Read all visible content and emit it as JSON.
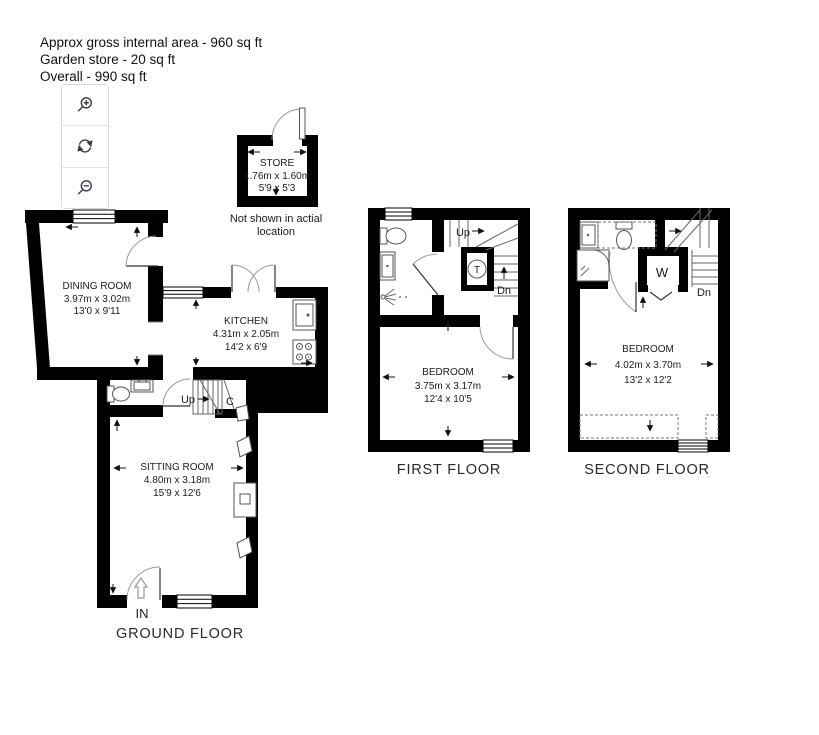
{
  "header": {
    "lines": [
      "Approx gross internal area - 960 sq ft",
      "Garden store - 20 sq ft",
      "Overall - 990 sq ft"
    ]
  },
  "toolbar": {
    "icons": [
      "magnifier-plus",
      "rotate-arrows",
      "magnifier-minus"
    ]
  },
  "store": {
    "name": "STORE",
    "size_metric": "1.76m x 1.60m",
    "size_imperial": "5'9 x 5'3",
    "note_line1": "Not shown in actial",
    "note_line2": "location"
  },
  "floors": {
    "ground": {
      "label": "GROUND FLOOR",
      "rooms": {
        "dining": {
          "name": "DINING ROOM",
          "metric": "3.97m x 3.02m",
          "imperial": "13'0 x 9'11"
        },
        "kitchen": {
          "name": "KITCHEN",
          "metric": "4.31m x 2.05m",
          "imperial": "14'2 x 6'9"
        },
        "sitting": {
          "name": "SITTING ROOM",
          "metric": "4.80m x 3.18m",
          "imperial": "15'9 x 12'6"
        }
      },
      "annotations": {
        "up": "Up",
        "cupboard": "C",
        "entrance": "IN"
      }
    },
    "first": {
      "label": "FIRST FLOOR",
      "rooms": {
        "bedroom": {
          "name": "BEDROOM",
          "metric": "3.75m x 3.17m",
          "imperial": "12'4 x 10'5"
        }
      },
      "annotations": {
        "up": "Up",
        "down": "Dn",
        "tank": "T"
      }
    },
    "second": {
      "label": "SECOND FLOOR",
      "rooms": {
        "bedroom": {
          "name": "BEDROOM",
          "metric": "4.02m x 3.70m",
          "imperial": "13'2 x 12'2"
        }
      },
      "annotations": {
        "down": "Dn",
        "wardrobe": "W"
      }
    }
  }
}
